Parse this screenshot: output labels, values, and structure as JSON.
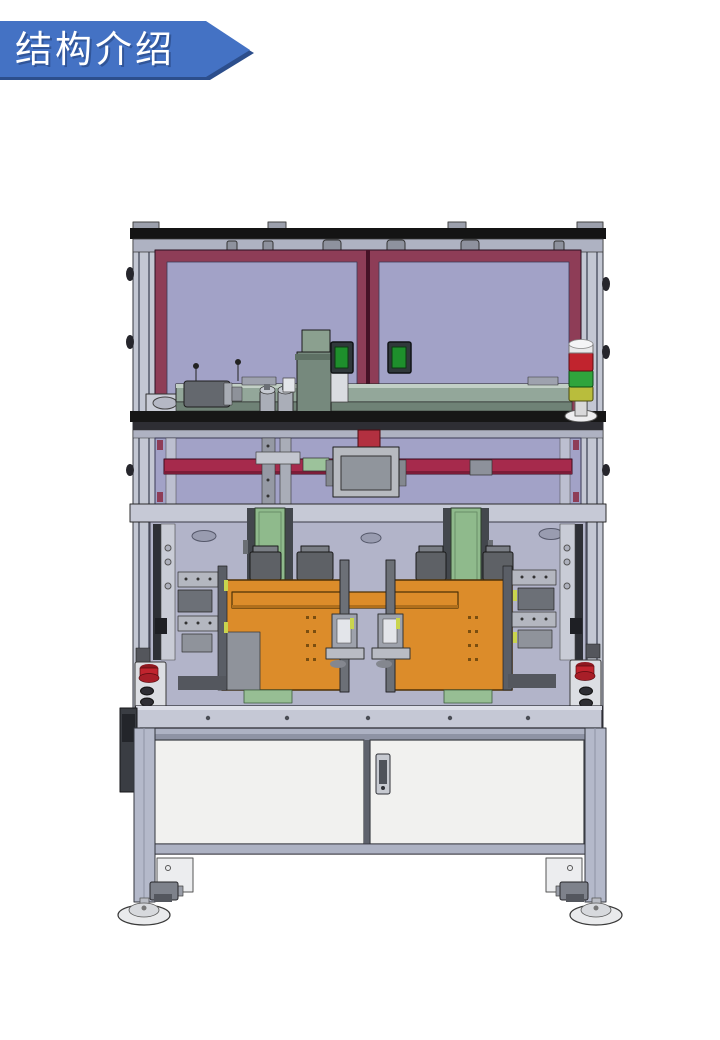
{
  "slide": {
    "title": "结构介绍",
    "background": "#FFFFFF"
  },
  "banner": {
    "label": "结构介绍",
    "fill": "#4472C4",
    "shadow": "#2C4E8C",
    "text_color": "#FFFFFF"
  },
  "machine": {
    "signal_tower_segments": [
      "red",
      "green",
      "yellow"
    ],
    "palette": {
      "frame_maroon": "#8E3D57",
      "panel_lavender": "#A2A2C7",
      "rail_crimson": "#A62A4C",
      "fixture_orange": "#DC8C2A",
      "bracket_green": "#8FBA8C",
      "strip_green": "#97BE94",
      "door_white": "#F1F1EF",
      "metal_light": "#C5C8D5",
      "metal_frame": "#ADB2C3",
      "light_red": "#C1242E",
      "light_green": "#2FA43C",
      "light_yellow": "#B9BD3C"
    }
  }
}
